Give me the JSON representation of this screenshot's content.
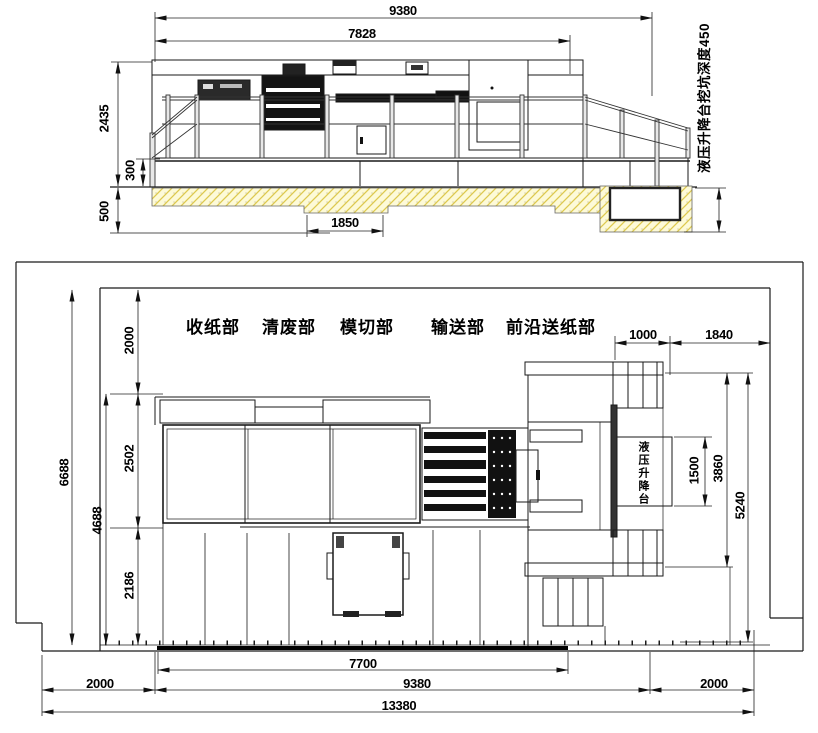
{
  "drawing": {
    "kind": "machine installation layout (elevation + plan)",
    "colors": {
      "line": "#1a1a1a",
      "hatch_fill": "#fdfad8",
      "hatch_line": "#ddc94f",
      "dark_fill": "#141414"
    }
  },
  "elevation": {
    "dim_overall_length": "9380",
    "dim_frame_length": "7828",
    "dim_height": "2435",
    "dim_base_height": "300",
    "dim_pit_depth": "500",
    "dim_center_pit": "1850",
    "pit_note": "液压升降台挖坑深度450"
  },
  "plan": {
    "sections": {
      "delivery": "收纸部",
      "stripping": "清废部",
      "diecut": "模切部",
      "transfer": "输送部",
      "feeder": "前沿送纸部"
    },
    "lift_label": "液压升降台",
    "dim_feeder_ext": "1000",
    "dim_corner": "1840",
    "dim_overall_depth": "6688",
    "dim_machine_depth": "4688",
    "dim_clearance_top": "2000",
    "dim_body_depth": "2502",
    "dim_lower_depth": "2186",
    "dim_lift_width": "1500",
    "dim_lift_zone": "3860",
    "dim_right_zone": "5240",
    "dim_base_length": "7700",
    "dim_machine_length": "9380",
    "dim_clearance_left": "2000",
    "dim_clearance_right": "2000",
    "dim_overall_length": "13380"
  }
}
